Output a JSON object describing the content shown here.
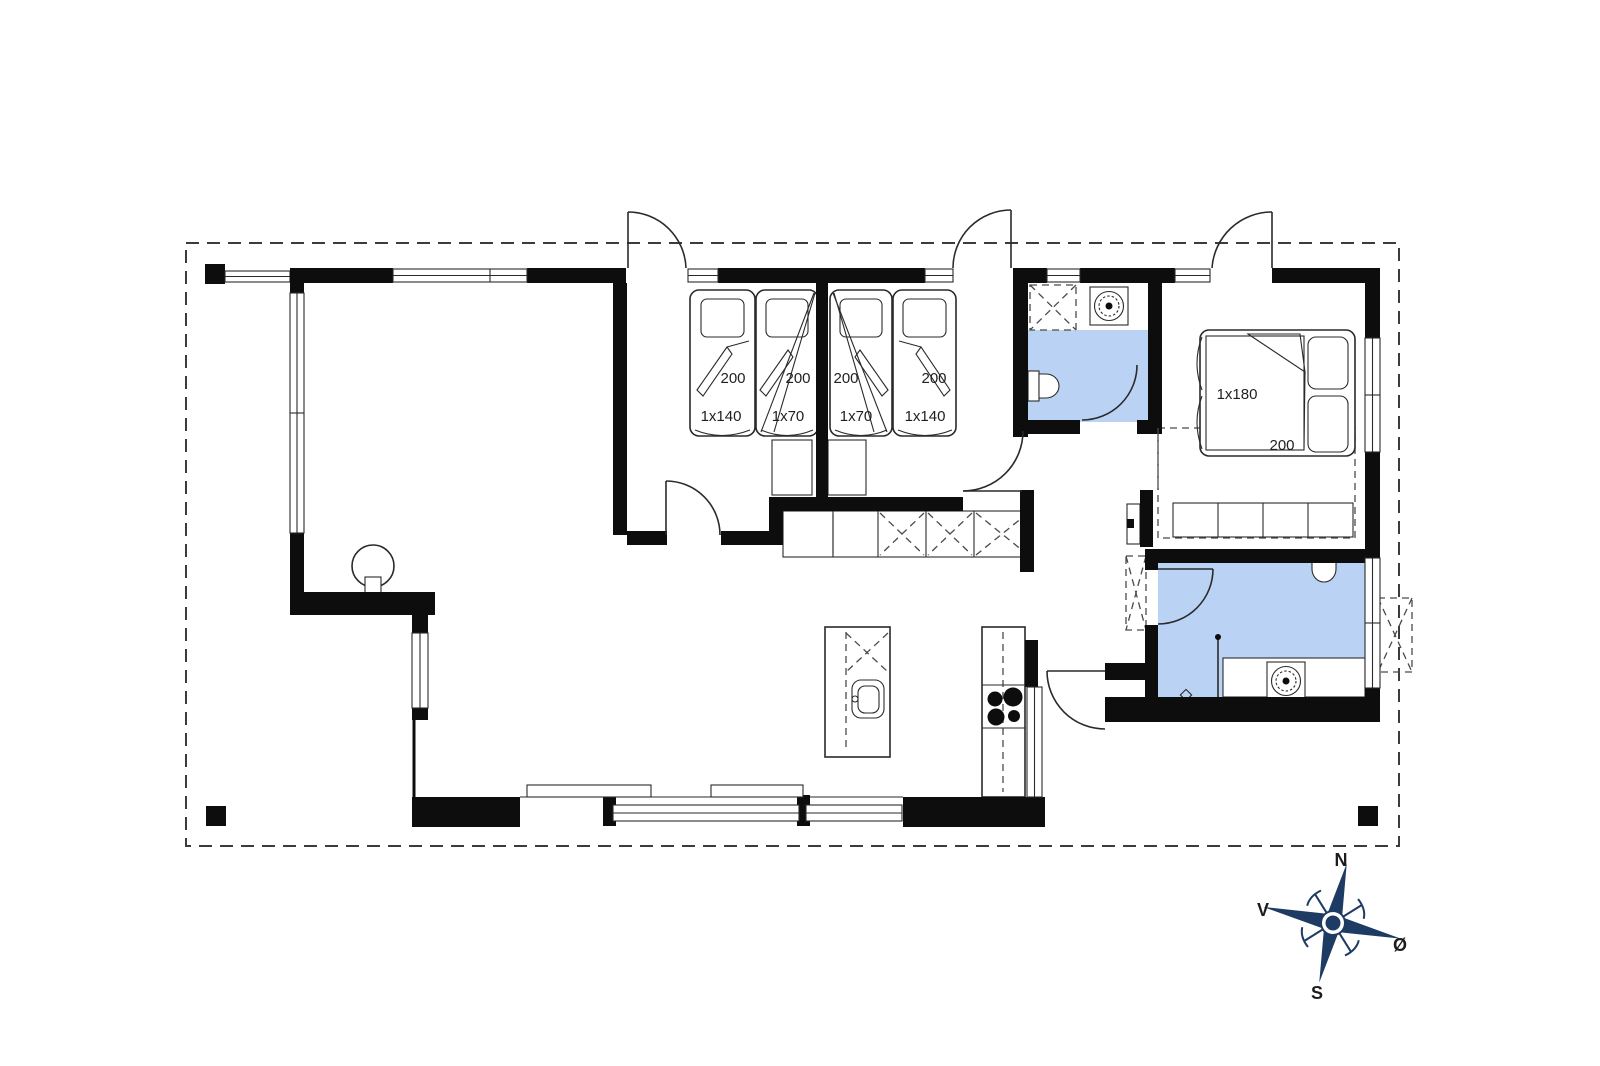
{
  "colors": {
    "wall": "#0d0d0d",
    "line": "#2a2a2a",
    "bath_floor": "#bad3f4",
    "compass": "#1d3b63",
    "text": "#1f1f1f"
  },
  "rooms": {
    "bedroom1": {
      "beds": [
        {
          "width_label": "1x140",
          "length_label": "200"
        },
        {
          "width_label": "1x70",
          "length_label": "200"
        }
      ]
    },
    "bedroom2": {
      "beds": [
        {
          "width_label": "1x70",
          "length_label": "200"
        },
        {
          "width_label": "1x140",
          "length_label": "200"
        }
      ]
    },
    "master_bedroom": {
      "bed": {
        "width_label": "1x180",
        "length_label": "200"
      }
    }
  },
  "compass": {
    "north": "N",
    "south": "S",
    "west": "V",
    "east": "Ø"
  }
}
